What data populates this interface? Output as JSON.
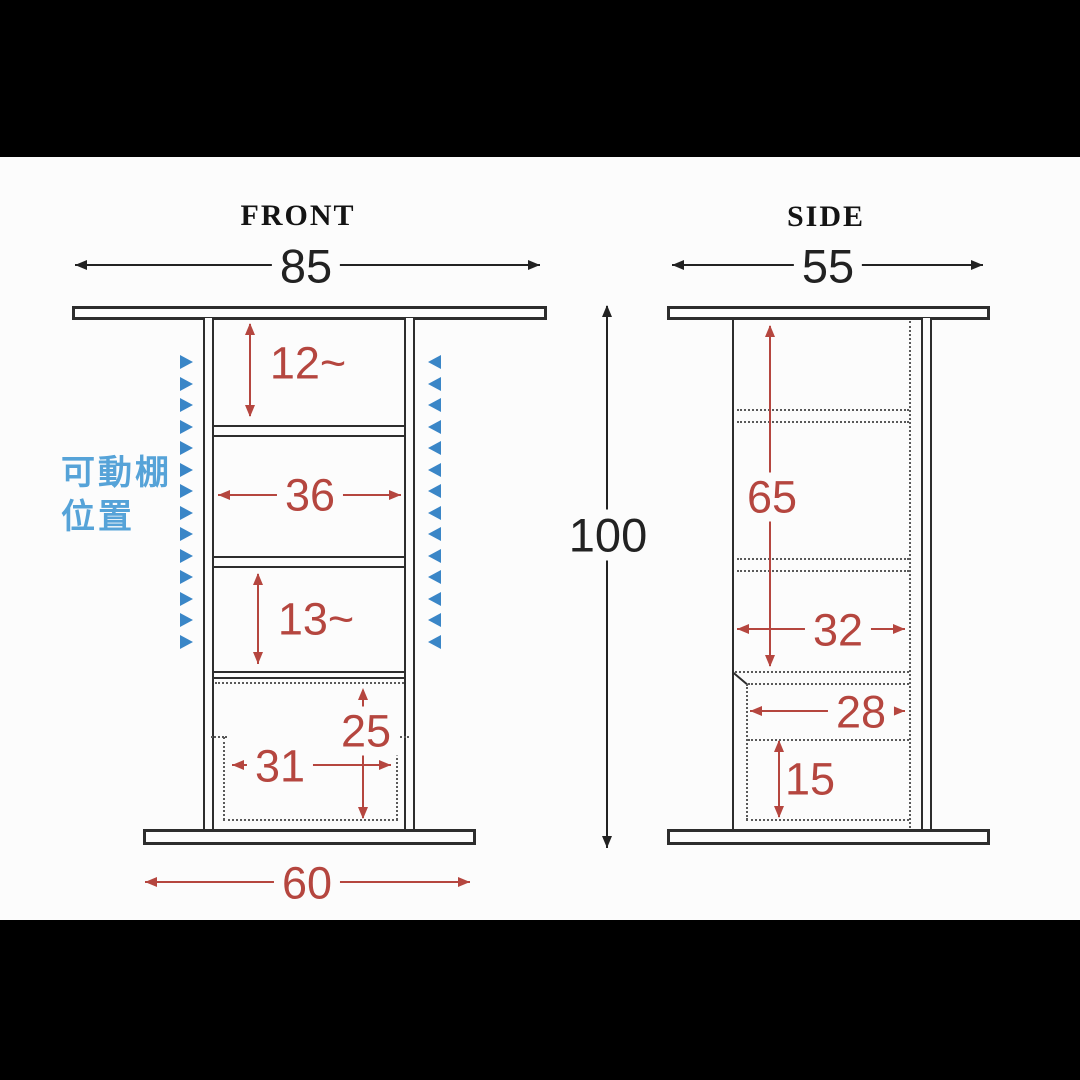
{
  "overall": {
    "height_label": "100"
  },
  "front_view": {
    "title": "FRONT",
    "width_label": "85",
    "base_width_label": "60",
    "top_section_height_label": "12~",
    "shelf_width_label": "36",
    "middle_section_height_label": "13~",
    "lower_clearance_height_label": "25",
    "lower_clearance_width_label": "31",
    "movable_shelf_label": {
      "line1": "可動棚",
      "line2": "位置"
    },
    "shelf_pin_marks_per_side": 14
  },
  "side_view": {
    "title": "SIDE",
    "width_label": "55",
    "interior_height_label": "65",
    "upper_depth_label": "32",
    "lower_depth_label": "28",
    "lower_section_height_label": "15"
  },
  "colors": {
    "dimension_red": "#b5463f",
    "structure_dark": "#2d2d2d",
    "dotted_gray": "#5a5a5a",
    "pin_blue": "#3a86c7",
    "shelf_label_blue": "#56a3d8"
  }
}
